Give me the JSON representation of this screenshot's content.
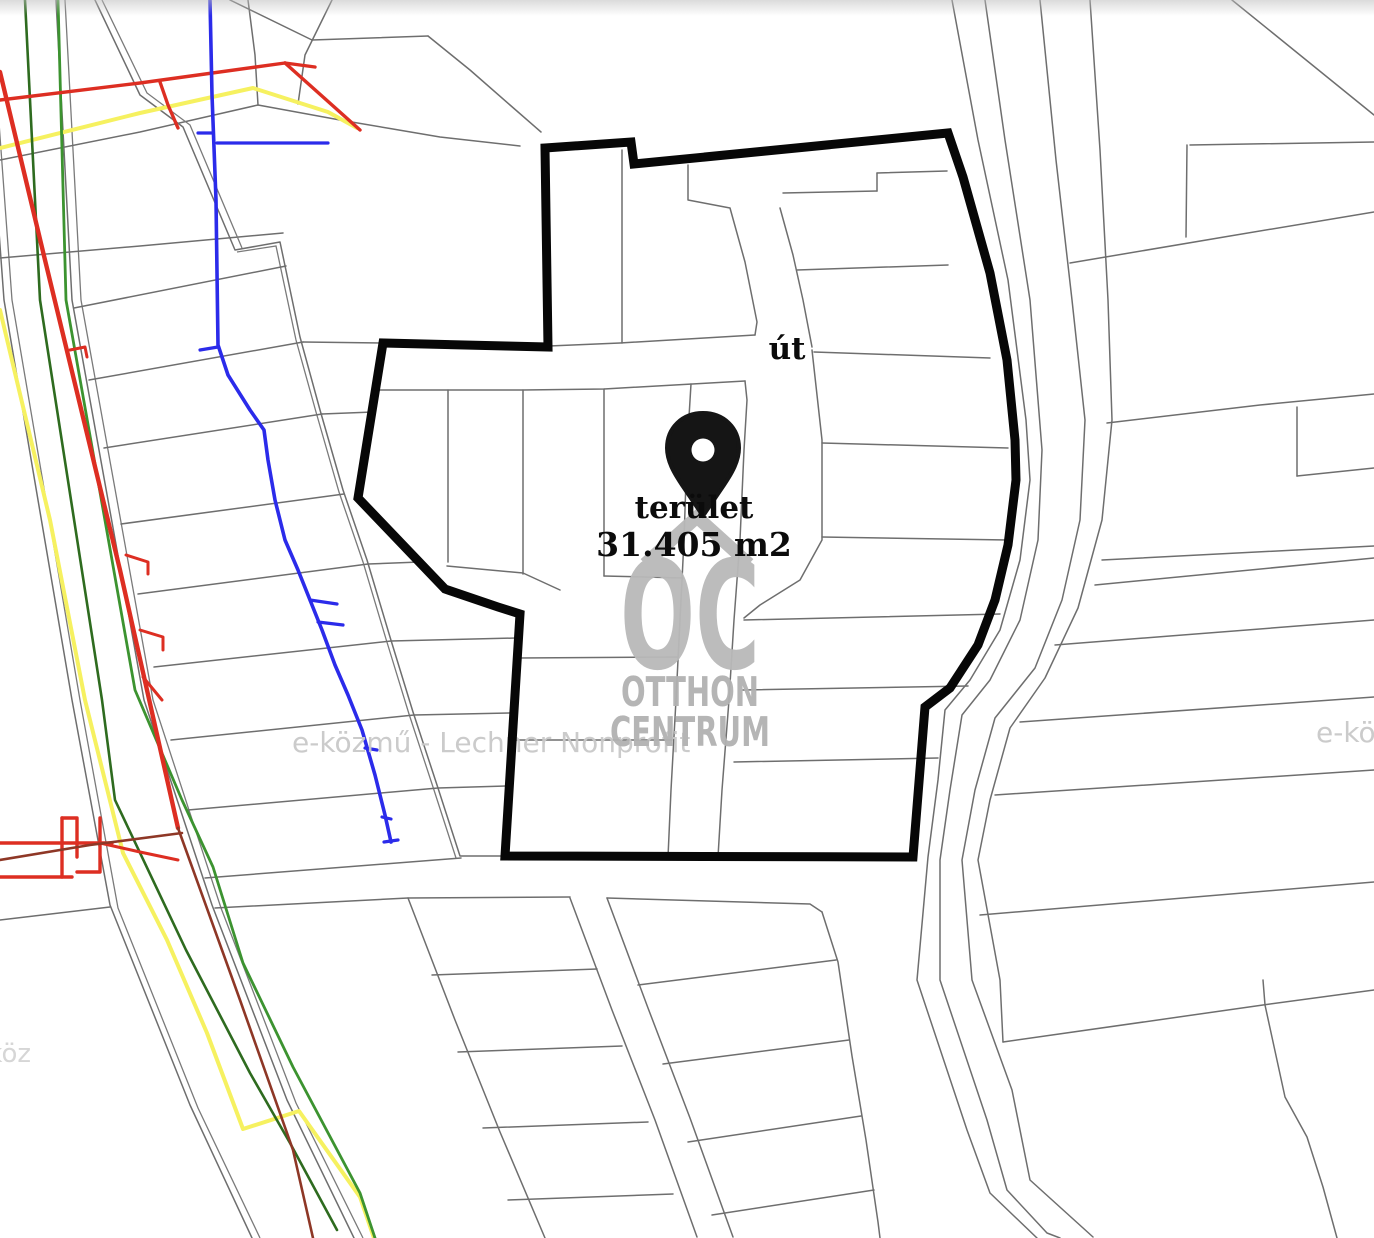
{
  "map": {
    "road_label": "út",
    "marker": {
      "caption": "terület",
      "area_value": "31.405 m2"
    },
    "watermark": {
      "logo_letters": "OC",
      "logo_word1": "OTTHON",
      "logo_word2": "CENTRUM",
      "tile_text": "e-közmű - Lechner Nonprofit",
      "tile_fragment_right": "e-köz",
      "tile_fragment_left": "e-köz"
    },
    "colors": {
      "boundary": "#070707",
      "parcel_line": "#6e6e6e",
      "water_blue": "#2b2bea",
      "electric_red": "#dd2e22",
      "gas_yellow": "#f6f160",
      "sewer_green": "#3c9330",
      "sewer_dark_green": "#2e6b1f",
      "heat_maroon": "#8e3726",
      "watermark_gray": "#b9b9b9",
      "tile_gray": "#c9c9c9"
    }
  }
}
